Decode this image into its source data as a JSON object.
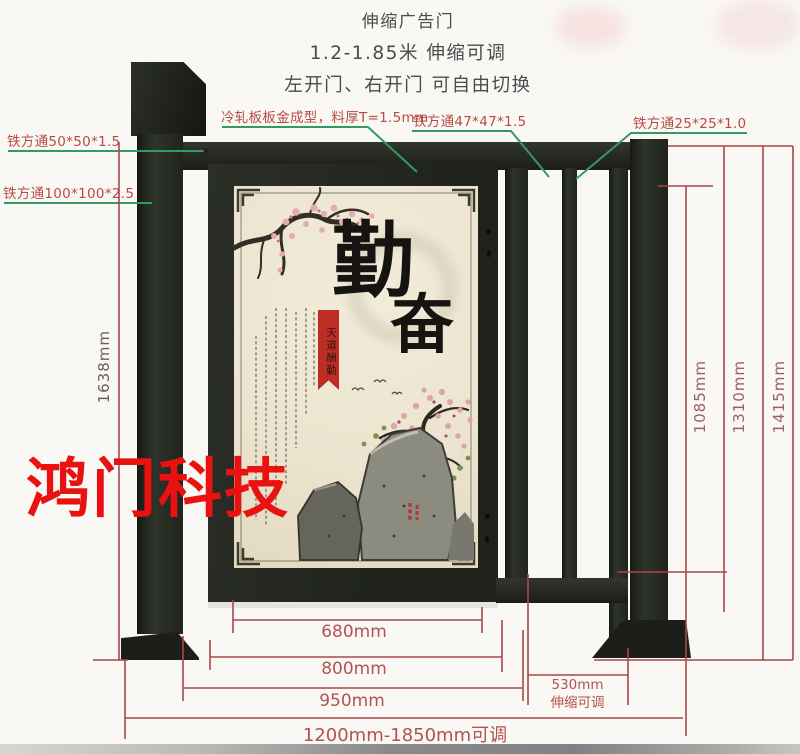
{
  "header": {
    "title": "伸缩广告门",
    "subtitle": "1.2-1.85米 伸缩可调",
    "subtitle2": "左开门、右开门 可自由切换"
  },
  "callouts": {
    "square_tube_50": "铁方通50*50*1.5",
    "square_tube_100": "铁方通100*100*2.5",
    "cold_rolled_panel": "冷轧板板金成型，料厚T=1.5mm",
    "square_tube_47": "铁方通47*47*1.5",
    "square_tube_25": "铁方通25*25*1.0"
  },
  "dimensions": {
    "post_height": "1638mm",
    "opening_height": "1085mm",
    "rail_height": "1310mm",
    "total_height": "1415mm",
    "panel_width": "680mm",
    "door_width": "800mm",
    "door_total_width": "950mm",
    "telescopic_width": "530mm",
    "telescopic_note": "伸缩可调",
    "overall_range": "1200mm-1850mm可调"
  },
  "watermark": "鸿门科技",
  "poster": {
    "calligraphy_top": "勤",
    "calligraphy_bottom": "奋",
    "seal_text": "天道酬勤"
  },
  "colors": {
    "dimension_red": "#a84848",
    "label_red": "#b84a44",
    "leader_green": "#359a62",
    "watermark_red": "#ea1111",
    "gate_dark": "#262a23",
    "poster_cream": "#ece4cf"
  }
}
